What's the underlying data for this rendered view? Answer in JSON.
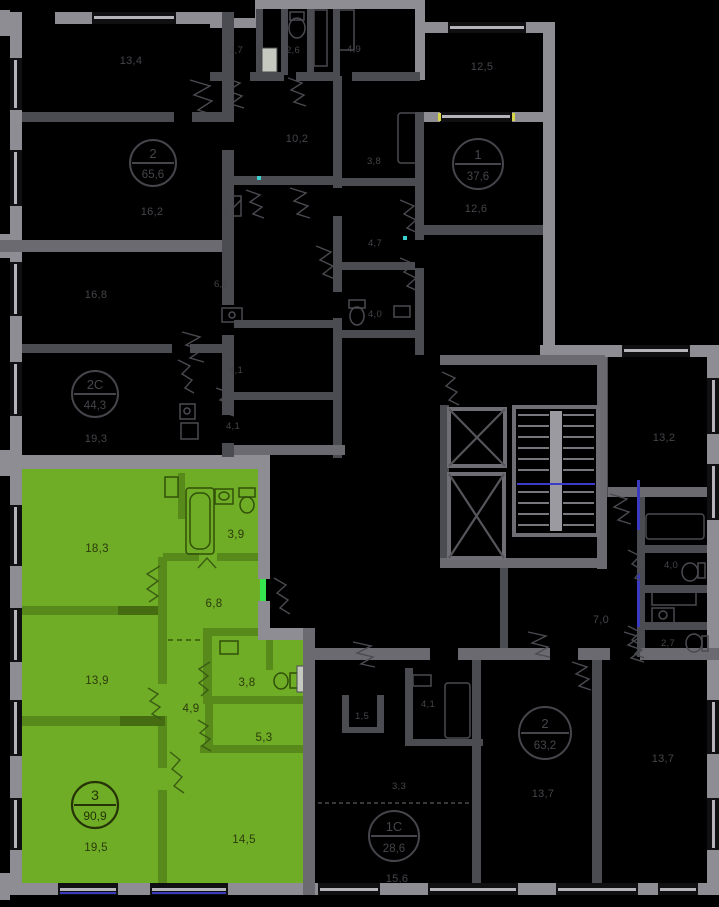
{
  "colors": {
    "background": "#000000",
    "outer_wall": "#8d8d93",
    "inner_wall_dark": "#4b4b52",
    "inner_wall_mid": "#6a6a70",
    "dim_label_text": "#45454b",
    "selected_fill": "#6fad26",
    "selected_wall": "#578a1b",
    "selected_text": "#2c3b0c",
    "entry_door_highlight": "#35e44e",
    "stair_rail_blue": "#3c3cc6",
    "window_line": "#b4b4ba"
  },
  "selected_apartment": {
    "stamp": {
      "rooms_count": "3",
      "total_area": "90,9"
    },
    "room_areas": [
      "18,3",
      "3,9",
      "6,8",
      "13,9",
      "3,8",
      "4,9",
      "5,3",
      "19,5",
      "14,5"
    ]
  },
  "other_apartment_stamps": [
    {
      "rooms_count": "2",
      "total_area": "65,6"
    },
    {
      "rooms_count": "2С",
      "total_area": "44,3"
    },
    {
      "rooms_count": "1",
      "total_area": "37,6"
    },
    {
      "rooms_count": "2",
      "total_area": "63,2"
    },
    {
      "rooms_count": "1С",
      "total_area": "28,6"
    }
  ],
  "room_area_labels": [
    "13,4",
    "2,7",
    "2,6",
    "4,9",
    "10,2",
    "12,5",
    "16,2",
    "3,8",
    "12,6",
    "4,7",
    "4,0",
    "16,8",
    "6,2",
    "4,1",
    "4,1",
    "19,3",
    "13,2",
    "4,0",
    "7,0",
    "2,7",
    "1,5",
    "4,1",
    "3,3",
    "15,6",
    "13,7",
    "13,7"
  ]
}
